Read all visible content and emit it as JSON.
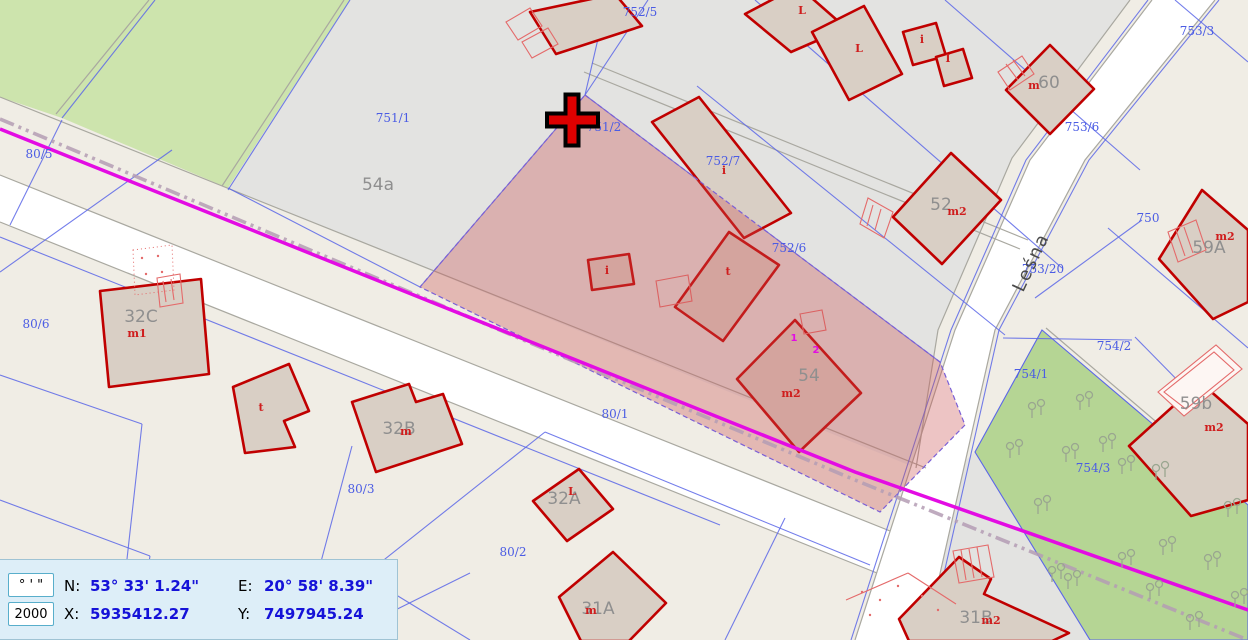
{
  "app": {
    "type": "cadastral-map-viewer"
  },
  "theme": {
    "bg_beige": "#f0ede5",
    "region_gray": "#e3e3e1",
    "green_light": "#cde4ad",
    "green_dark": "#b5d594",
    "road_white": "#ffffff",
    "line_gray": "#a9a8a0",
    "line_blue": "#5b66e8",
    "label_blue": "#4b5ce4",
    "label_gray": "#8f8f8f",
    "building_fill": "#d9cfc5",
    "building_stroke": "#c00000",
    "thin_red": "#e46a6a",
    "mark_red": "#cf1d1d",
    "magenta": "#e30ce3",
    "dashdot": "#b49cb4",
    "tree_gray": "#9aa690",
    "highlight": "rgba(203,82,82,0.34)",
    "panel_bg": "#ddeef8",
    "panel_border": "#58aecb",
    "value_blue": "#1512d8"
  },
  "status_panel": {
    "units_button": "° ' \"",
    "scale_value": "2000",
    "lat_label": "N:",
    "lat_value": "53° 33' 1.24\"",
    "lon_label": "E:",
    "lon_value": "20° 58' 8.39\"",
    "x_label": "X:",
    "x_value": "5935412.27",
    "y_label": "Y:",
    "y_value": "7497945.24"
  },
  "map": {
    "street": {
      "t": "Leśna",
      "x": 1023,
      "y": 293,
      "rot": -65
    },
    "parcel_labels": [
      {
        "t": "752/5",
        "x": 640,
        "y": 16
      },
      {
        "t": "751/1",
        "x": 393,
        "y": 122
      },
      {
        "t": "751/2",
        "x": 604,
        "y": 131
      },
      {
        "t": "752/6",
        "x": 789,
        "y": 252
      },
      {
        "t": "752/7",
        "x": 723,
        "y": 165
      },
      {
        "t": "753/3",
        "x": 1197,
        "y": 35
      },
      {
        "t": "753/6",
        "x": 1082,
        "y": 131
      },
      {
        "t": "750",
        "x": 1148,
        "y": 222
      },
      {
        "t": "753/20",
        "x": 1043,
        "y": 273
      },
      {
        "t": "80/5",
        "x": 39,
        "y": 158
      },
      {
        "t": "80/6",
        "x": 36,
        "y": 328
      },
      {
        "t": "80/3",
        "x": 361,
        "y": 493
      },
      {
        "t": "80/2",
        "x": 513,
        "y": 556
      },
      {
        "t": "80/1",
        "x": 615,
        "y": 418
      },
      {
        "t": "754/2",
        "x": 1114,
        "y": 350
      },
      {
        "t": "754/1",
        "x": 1031,
        "y": 378
      },
      {
        "t": "754/3",
        "x": 1093,
        "y": 472
      }
    ],
    "area_labels": [
      {
        "t": "54a",
        "x": 378,
        "y": 190
      },
      {
        "t": "54",
        "x": 809,
        "y": 381
      },
      {
        "t": "52",
        "x": 941,
        "y": 210
      },
      {
        "t": "60",
        "x": 1049,
        "y": 88
      },
      {
        "t": "32C",
        "x": 141,
        "y": 322
      },
      {
        "t": "32B",
        "x": 399,
        "y": 434
      },
      {
        "t": "32A",
        "x": 564,
        "y": 504
      },
      {
        "t": "31A",
        "x": 598,
        "y": 614
      },
      {
        "t": "31B",
        "x": 976,
        "y": 623
      },
      {
        "t": "59A",
        "x": 1209,
        "y": 253
      },
      {
        "t": "59b",
        "x": 1196,
        "y": 409
      }
    ],
    "building_marks": [
      {
        "t": "m2",
        "x": 1225,
        "y": 240
      },
      {
        "t": "m2",
        "x": 1214,
        "y": 431
      },
      {
        "t": "m2",
        "x": 791,
        "y": 397
      },
      {
        "t": "m2",
        "x": 957,
        "y": 215
      },
      {
        "t": "m",
        "x": 1034,
        "y": 89
      },
      {
        "t": "m2",
        "x": 991,
        "y": 624
      },
      {
        "t": "m1",
        "x": 137,
        "y": 337
      },
      {
        "t": "m",
        "x": 406,
        "y": 435
      },
      {
        "t": "m",
        "x": 591,
        "y": 614
      },
      {
        "t": "L",
        "x": 572,
        "y": 495
      },
      {
        "t": "L",
        "x": 802,
        "y": 14
      },
      {
        "t": "L",
        "x": 859,
        "y": 52
      },
      {
        "t": "i",
        "x": 922,
        "y": 43
      },
      {
        "t": "I",
        "x": 948,
        "y": 62
      },
      {
        "t": "i",
        "x": 724,
        "y": 174
      },
      {
        "t": "i",
        "x": 607,
        "y": 274
      },
      {
        "t": "t",
        "x": 728,
        "y": 275
      },
      {
        "t": "t",
        "x": 261,
        "y": 411
      }
    ],
    "utility_marks": [
      {
        "t": "1",
        "x": 794,
        "y": 341
      },
      {
        "t": "2",
        "x": 816,
        "y": 353
      }
    ]
  }
}
